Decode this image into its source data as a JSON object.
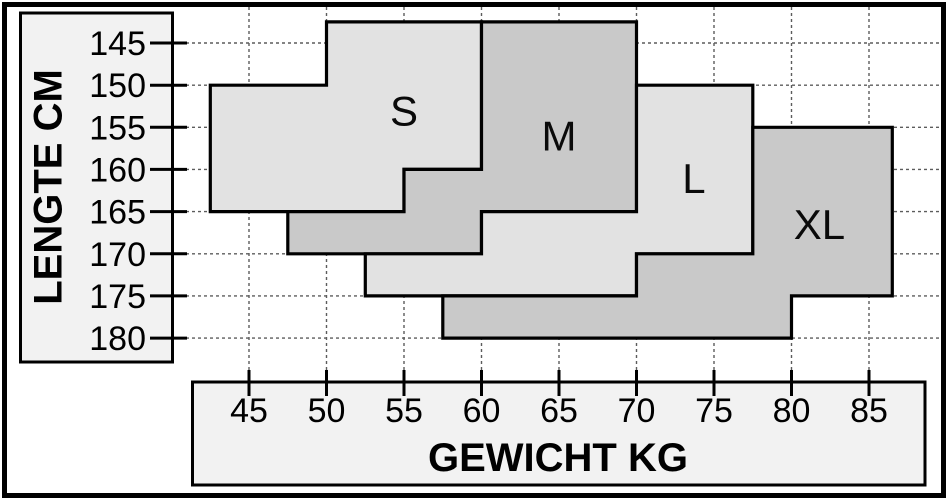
{
  "chart_data": {
    "type": "area",
    "title": "",
    "xlabel": "GEWICHT KG",
    "ylabel": "LENGTE CM",
    "x_ticks": [
      45,
      50,
      55,
      60,
      65,
      70,
      75,
      80,
      85
    ],
    "y_ticks": [
      145,
      150,
      155,
      160,
      165,
      170,
      175,
      180
    ],
    "xlim": [
      45,
      85
    ],
    "ylim": [
      145,
      180
    ],
    "grid": true,
    "legend_position": "none",
    "x_unit": "kg",
    "y_unit": "cm",
    "regions": [
      {
        "label": "S",
        "fill": "#e2e2e2",
        "label_at": [
          55,
          153
        ],
        "points": [
          [
            42.5,
            150
          ],
          [
            50,
            150
          ],
          [
            50,
            142.5
          ],
          [
            60,
            142.5
          ],
          [
            60,
            160
          ],
          [
            55,
            160
          ],
          [
            55,
            165
          ],
          [
            42.5,
            165
          ]
        ]
      },
      {
        "label": "M",
        "fill": "#c9c9c9",
        "label_at": [
          65,
          156
        ],
        "points": [
          [
            47.5,
            165
          ],
          [
            55,
            165
          ],
          [
            55,
            160
          ],
          [
            60,
            160
          ],
          [
            60,
            142.5
          ],
          [
            70,
            142.5
          ],
          [
            70,
            165
          ],
          [
            60,
            165
          ],
          [
            60,
            170
          ],
          [
            47.5,
            170
          ]
        ]
      },
      {
        "label": "L",
        "fill": "#e2e2e2",
        "label_at": [
          73.7,
          161
        ],
        "points": [
          [
            52.5,
            170
          ],
          [
            60,
            170
          ],
          [
            60,
            165
          ],
          [
            70,
            165
          ],
          [
            70,
            150
          ],
          [
            77.5,
            150
          ],
          [
            77.5,
            170
          ],
          [
            70,
            170
          ],
          [
            70,
            175
          ],
          [
            52.5,
            175
          ]
        ]
      },
      {
        "label": "XL",
        "fill": "#c9c9c9",
        "label_at": [
          81.8,
          166.5
        ],
        "points": [
          [
            57.5,
            175
          ],
          [
            70,
            175
          ],
          [
            70,
            170
          ],
          [
            77.5,
            170
          ],
          [
            77.5,
            155
          ],
          [
            86.5,
            155
          ],
          [
            86.5,
            175
          ],
          [
            80,
            175
          ],
          [
            80,
            180
          ],
          [
            57.5,
            180
          ]
        ]
      }
    ]
  },
  "colors": {
    "region_light": "#e2e2e2",
    "region_dark": "#c9c9c9",
    "axis_box_fill": "#f2f2f2",
    "grid_line": "#5c5c5c",
    "outline": "#000000",
    "background": "#ffffff"
  }
}
